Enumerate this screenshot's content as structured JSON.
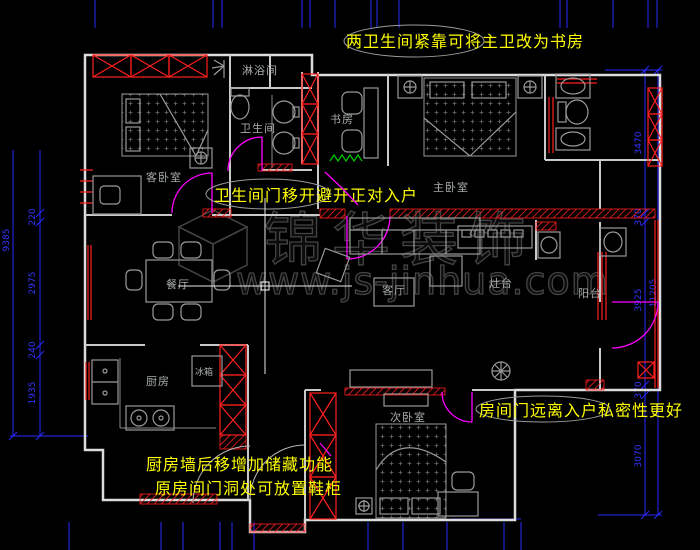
{
  "app": {
    "type": "cad-floor-plan-screenshot"
  },
  "watermark": {
    "brand": "锦华装饰",
    "url": "www.js-jinhua.com"
  },
  "rooms": {
    "shower": "淋浴间",
    "bathroom": "卫生间",
    "guest_bedroom": "客卧室",
    "study": "书房",
    "master_bedroom": "主卧室",
    "dining": "餐厅",
    "living": "客厅",
    "stove_counter": "灶台",
    "balcony": "阳台",
    "kitchen": "厨房",
    "fridge": "冰箱",
    "second_bedroom": "次卧室"
  },
  "annotations": {
    "top": "两卫生间紧靠可将主卫改为书房",
    "middle": "卫生间门移开避开正对入户",
    "bottom_line1": "厨房墙后移增加储藏功能",
    "bottom_line2": "原房间门洞处可放置鞋柜",
    "right": "房间门远离入户私密性更好"
  },
  "dimensions": {
    "left": {
      "segments": [
        "220",
        "2975",
        "240",
        "1935"
      ],
      "total": "9385"
    },
    "right": {
      "segments": [
        "3470",
        "370",
        "3925",
        "370",
        "3070"
      ],
      "total": "11205"
    }
  },
  "colors": {
    "background": "#000000",
    "walls_white": "#dcdcdc",
    "demolition_red": "#ff2020",
    "dimension_blue": "#2a2aff",
    "annotation_yellow": "#ffff00",
    "door_magenta": "#ff00ff",
    "radiator_green": "#00cc00",
    "furniture_gray": "#9a9a9a",
    "watermark_gray": "#565656"
  }
}
